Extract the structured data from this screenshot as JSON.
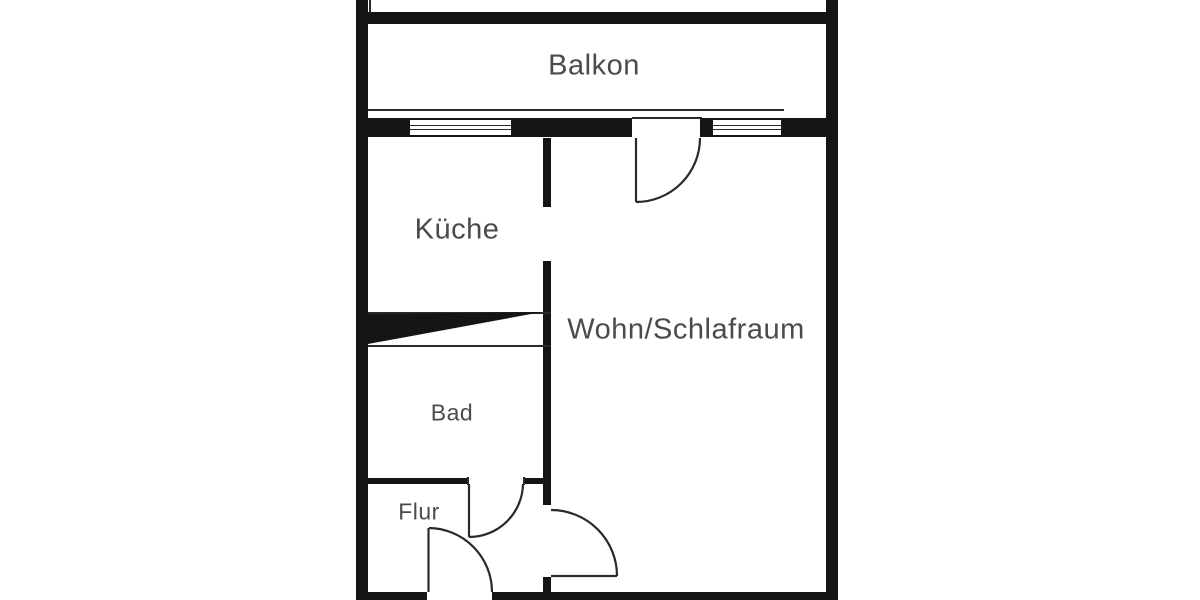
{
  "plan": {
    "type_label": "floor-plan",
    "rooms": [
      {
        "id": "balkon",
        "label": "Balkon"
      },
      {
        "id": "kueche",
        "label": "Küche"
      },
      {
        "id": "wohn-schlafraum",
        "label": "Wohn/Schlafraum"
      },
      {
        "id": "bad",
        "label": "Bad"
      },
      {
        "id": "flur",
        "label": "Flur"
      }
    ]
  },
  "colors": {
    "background": "#ffffff",
    "wall": "#151515",
    "line": "#2a2a2a",
    "label": "#4b4b4b"
  }
}
